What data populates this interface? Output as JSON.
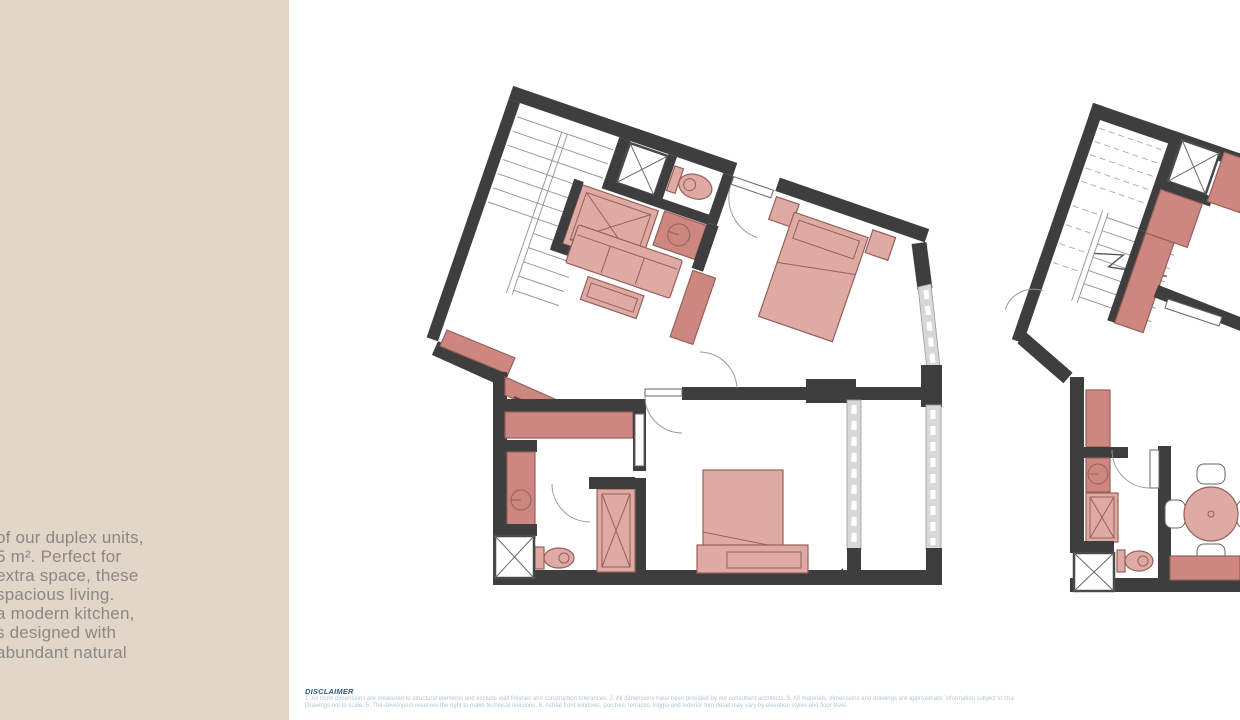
{
  "colors": {
    "sidebar-bg": "#e2d6c8",
    "sidebar-text": "#8b8884",
    "wall": "#3e3e3e",
    "furn-light": "#dfaaa4",
    "furn-dark": "#cd8680",
    "furn-stroke": "#96605a",
    "window-strip": "#d8d8d8",
    "stair-line": "#9a9a9a",
    "disclaimer-title": "#235f8e",
    "disclaimer-text": "#b4c6d7",
    "page-bg": "#ffffff"
  },
  "sidebar": {
    "lines": [
      "of our duplex units,",
      "5 m². Perfect for",
      "extra space, these",
      "spacious living.",
      "a modern kitchen,",
      "s designed with",
      "abundant natural"
    ]
  },
  "disclaimer": {
    "title": "DISCLAIMER",
    "line1": "1. All room dimensions are measured to structural elements and exclude wall finishes and construction tolerances. 2. All dimensions have been provided by our consultant architects. 3. All materials, dimensions and drawings are approximate, information subject to cha",
    "line2": "Drawings not to scale. 5. The developers reserves the right to make technical revisions. 6. Actual front windows, porches, terraces, loggia and exterior trim detail may vary by elevation styles and floor level."
  }
}
